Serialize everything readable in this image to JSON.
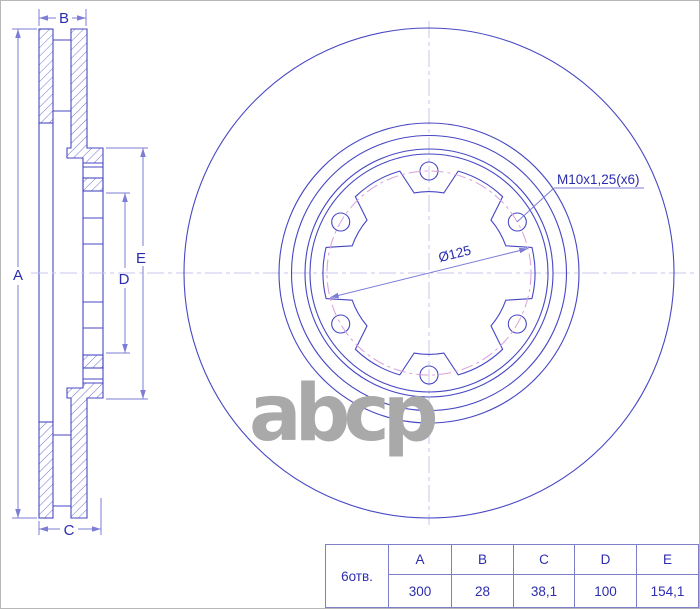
{
  "drawing": {
    "description": "Brake disc technical drawing, section view and front view",
    "dimension_labels": {
      "a": "A",
      "b": "B",
      "c": "C",
      "d": "D",
      "e": "E"
    },
    "annotations": {
      "thread_callout": "M10x1,25(x6)",
      "bolt_circle_diameter": "Ø125"
    },
    "colors": {
      "part_line": "#4747c3",
      "dimension_line": "#7d7dd6",
      "label_text": "#2b2bb0",
      "centerline": "#c9c4ec",
      "bolt_circle_dash": "#d9a0d8",
      "watermark": "#a9a9a9"
    }
  },
  "watermark": {
    "text": "abcp"
  },
  "table": {
    "row_label": "6отв.",
    "columns": [
      "A",
      "B",
      "C",
      "D",
      "E"
    ],
    "values": [
      "300",
      "28",
      "38,1",
      "100",
      "154,1"
    ]
  }
}
